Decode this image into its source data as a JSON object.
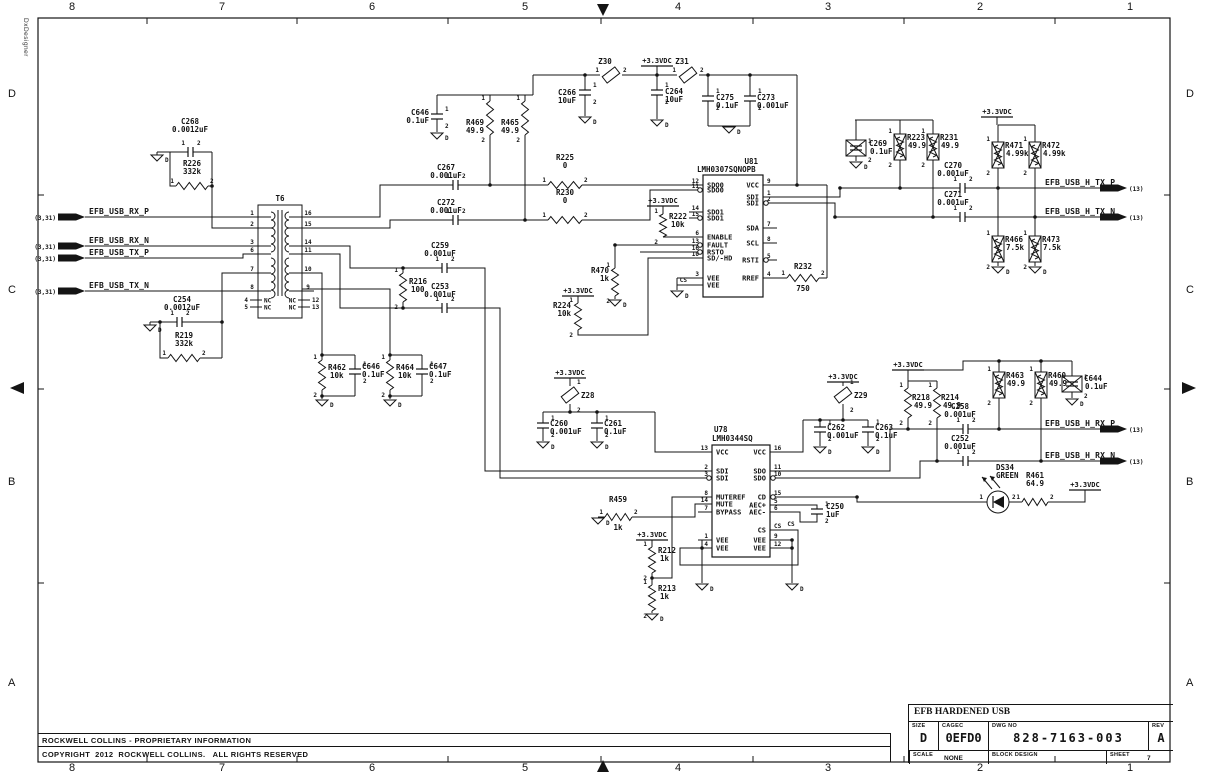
{
  "app": {
    "vertical_label": "DxDesigner"
  },
  "border": {
    "columns": [
      "8",
      "7",
      "6",
      "5",
      "4",
      "3",
      "2",
      "1"
    ],
    "rows": [
      "D",
      "C",
      "B",
      "A"
    ]
  },
  "footer": {
    "proprietary": "ROCKWELL COLLINS - PROPRIETARY INFORMATION",
    "copyright": "COPYRIGHT  2012  ROCKWELL COLLINS.   ALL RIGHTS RESERVED"
  },
  "title_block": {
    "project": "EFB HARDENED USB",
    "size_label": "SIZE",
    "size": "D",
    "cage_label": "CAGEC",
    "cage_code": "0EFD0",
    "dwg_label": "DWG NO",
    "dwg_no": "828-7163-003",
    "rev_label": "REV",
    "rev": "A",
    "scale_label": "SCALE",
    "scale": "NONE",
    "block_label": "BLOCK DESIGN",
    "sheet_label": "SHEET",
    "sheet": "7"
  },
  "labels": {
    "power": "+3.3VDC",
    "ground": "D",
    "nc": "NC",
    "cs": "CS"
  },
  "pin_markers": [
    "1",
    "2"
  ],
  "left_ports": [
    {
      "ref": "(3,31)",
      "name": "EFB_USB_RX_P"
    },
    {
      "ref": "(3,31)",
      "name": "EFB_USB_RX_N"
    },
    {
      "ref": "(3,31)",
      "name": "EFB_USB_TX_P"
    },
    {
      "ref": "(3,31)",
      "name": "EFB_USB_TX_N"
    }
  ],
  "right_ports": [
    {
      "name": "EFB_USB_H_TX_P",
      "ref": "(13)"
    },
    {
      "name": "EFB_USB_H_TX_N",
      "ref": "(13)"
    },
    {
      "name": "EFB_USB_H_RX_P",
      "ref": "(13)"
    },
    {
      "name": "EFB_USB_H_RX_N",
      "ref": "(13)"
    }
  ],
  "transformer": {
    "ref": "T6",
    "pins_left": [
      "1",
      "2",
      "3",
      "6",
      "7",
      "8"
    ],
    "pins_right": [
      "16",
      "15",
      "14",
      "11",
      "10",
      "9"
    ],
    "nc_pins_left": [
      "4",
      "5"
    ],
    "nc_pins_right": [
      "12",
      "13"
    ]
  },
  "ics": [
    {
      "id": "U81",
      "ref": "U81",
      "part": "LMH0307SQNOPB",
      "left": [
        [
          "12",
          "SDO0",
          0
        ],
        [
          "11",
          "SDO0",
          1
        ],
        [
          "14",
          "SDO1",
          0
        ],
        [
          "15",
          "SDO1",
          1
        ],
        [
          "6",
          "ENABLE",
          0
        ],
        [
          "13",
          "FAULT",
          1
        ],
        [
          "16",
          "RSTO",
          1
        ],
        [
          "10",
          "SD/-HD",
          0
        ],
        [
          "3",
          "VEE",
          0
        ],
        [
          "",
          "VEE",
          0
        ]
      ],
      "right": [
        [
          "9",
          "VCC",
          0
        ],
        [
          "1",
          "SDI",
          0
        ],
        [
          "2",
          "SDI",
          1
        ],
        [
          "7",
          "SDA",
          0
        ],
        [
          "8",
          "SCL",
          0
        ],
        [
          "5",
          "RSTI",
          1
        ],
        [
          "4",
          "RREF",
          0
        ]
      ]
    },
    {
      "id": "U78",
      "ref": "U78",
      "part": "LMH0344SQ",
      "left": [
        [
          "13",
          "VCC",
          0
        ],
        [
          "2",
          "SDI",
          0
        ],
        [
          "3",
          "SDI",
          1
        ],
        [
          "8",
          "MUTEREF",
          0
        ],
        [
          "14",
          "MUTE",
          0
        ],
        [
          "7",
          "BYPASS",
          0
        ],
        [
          "1",
          "VEE",
          0
        ],
        [
          "4",
          "VEE",
          0
        ]
      ],
      "right": [
        [
          "16",
          "VCC",
          0
        ],
        [
          "11",
          "SDO",
          0
        ],
        [
          "10",
          "SDO",
          1
        ],
        [
          "15",
          "CD",
          1
        ],
        [
          "5",
          "AEC+",
          0
        ],
        [
          "6",
          "AEC-",
          0
        ],
        [
          "CS",
          "CS",
          0
        ],
        [
          "9",
          "VEE",
          0
        ],
        [
          "12",
          "VEE",
          0
        ]
      ]
    }
  ],
  "components": {
    "C268": {
      "ref": "C268",
      "value": "0.0012uF"
    },
    "R226": {
      "ref": "R226",
      "value": "332k"
    },
    "C254": {
      "ref": "C254",
      "value": "0.0012uF"
    },
    "R219": {
      "ref": "R219",
      "value": "332k"
    },
    "C267": {
      "ref": "C267",
      "value": "0.001uF"
    },
    "C272": {
      "ref": "C272",
      "value": "0.001uF"
    },
    "R225": {
      "ref": "R225",
      "value": "0"
    },
    "R230": {
      "ref": "R230",
      "value": "0"
    },
    "C259": {
      "ref": "C259",
      "value": "0.001uF"
    },
    "C253": {
      "ref": "C253",
      "value": "0.001uF"
    },
    "R216": {
      "ref": "R216",
      "value": "100"
    },
    "C646a": {
      "ref": "C646",
      "value": "0.1uF"
    },
    "R469": {
      "ref": "R469",
      "value": "49.9"
    },
    "R465": {
      "ref": "R465",
      "value": "49.9"
    },
    "C266": {
      "ref": "C266",
      "value": "10uF"
    },
    "C264": {
      "ref": "C264",
      "value": "10uF"
    },
    "C275": {
      "ref": "C275",
      "value": "0.1uF"
    },
    "C273": {
      "ref": "C273",
      "value": "0.001uF"
    },
    "Z30": {
      "ref": "Z30",
      "value": ""
    },
    "Z31": {
      "ref": "Z31",
      "value": ""
    },
    "R222": {
      "ref": "R222",
      "value": "10k"
    },
    "R470": {
      "ref": "R470",
      "value": "1k"
    },
    "R224": {
      "ref": "R224",
      "value": "10k"
    },
    "R232": {
      "ref": "R232",
      "value": "750"
    },
    "C269": {
      "ref": "C269",
      "value": "0.1uF"
    },
    "R223": {
      "ref": "R223",
      "value": "49.9"
    },
    "R231": {
      "ref": "R231",
      "value": "49.9"
    },
    "R471": {
      "ref": "R471",
      "value": "4.99k"
    },
    "R472": {
      "ref": "R472",
      "value": "4.99k"
    },
    "C270": {
      "ref": "C270",
      "value": "0.001uF"
    },
    "C271": {
      "ref": "C271",
      "value": "0.001uF"
    },
    "R466": {
      "ref": "R466",
      "value": "7.5k"
    },
    "R473": {
      "ref": "R473",
      "value": "7.5k"
    },
    "R462": {
      "ref": "R462",
      "value": "10k"
    },
    "C646b": {
      "ref": "C646",
      "value": "0.1uF"
    },
    "R464": {
      "ref": "R464",
      "value": "10k"
    },
    "C647": {
      "ref": "C647",
      "value": "0.1uF"
    },
    "Z28": {
      "ref": "Z28",
      "value": ""
    },
    "C260": {
      "ref": "C260",
      "value": "0.001uF"
    },
    "C261": {
      "ref": "C261",
      "value": "0.1uF"
    },
    "Z29": {
      "ref": "Z29",
      "value": ""
    },
    "C262": {
      "ref": "C262",
      "value": "0.001uF"
    },
    "C263": {
      "ref": "C263",
      "value": "0.1uF"
    },
    "R218": {
      "ref": "R218",
      "value": "49.9"
    },
    "R214": {
      "ref": "R214",
      "value": "49.9"
    },
    "C258": {
      "ref": "C258",
      "value": "0.001uF"
    },
    "C252": {
      "ref": "C252",
      "value": "0.001uF"
    },
    "R463": {
      "ref": "R463",
      "value": "49.9"
    },
    "R460": {
      "ref": "R460",
      "value": "49.9"
    },
    "C644": {
      "ref": "C644",
      "value": "0.1uF"
    },
    "C250": {
      "ref": "C250",
      "value": "1uF"
    },
    "R459": {
      "ref": "R459",
      "value": "1k"
    },
    "R212": {
      "ref": "R212",
      "value": "1k"
    },
    "R213": {
      "ref": "R213",
      "value": "1k"
    },
    "R461": {
      "ref": "R461",
      "value": "64.9"
    },
    "DS34": {
      "ref": "DS34",
      "value": "GREEN"
    }
  }
}
